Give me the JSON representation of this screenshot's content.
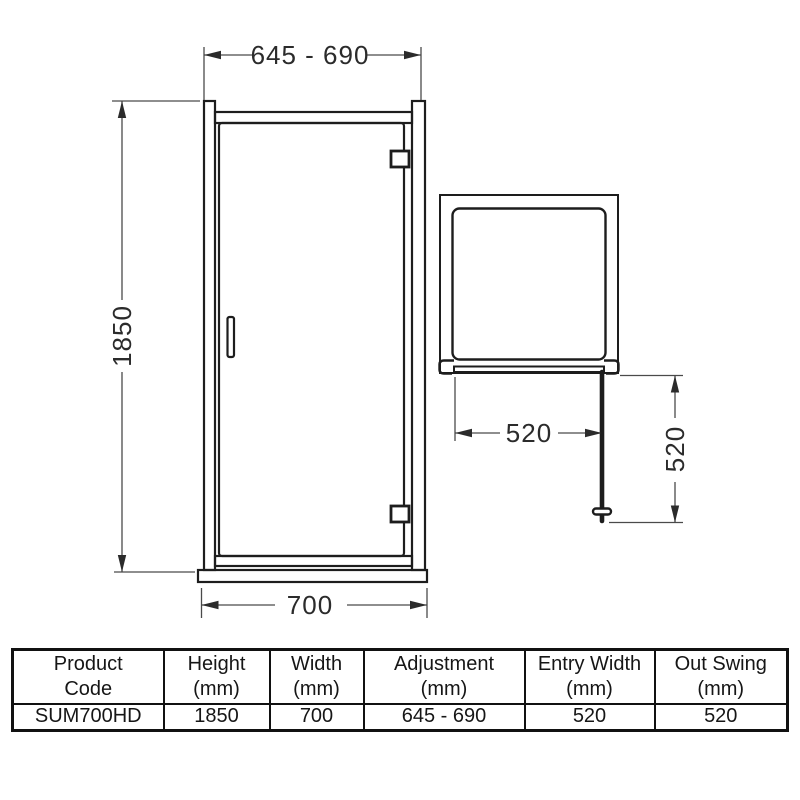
{
  "front_view": {
    "adjustment": "645 - 690",
    "height": "1850",
    "width": "700"
  },
  "plan_view": {
    "entry_width": "520",
    "out_swing": "520"
  },
  "colors": {
    "object_line": "#1d1d1d",
    "dimension_line": "#4a4a4a",
    "text": "#2b2b2b",
    "background": "#ffffff"
  },
  "spec_table": {
    "headers": [
      {
        "line1": "Product",
        "line2": "Code"
      },
      {
        "line1": "Height",
        "line2": "(mm)"
      },
      {
        "line1": "Width",
        "line2": "(mm)"
      },
      {
        "line1": "Adjustment",
        "line2": "(mm)"
      },
      {
        "line1": "Entry Width",
        "line2": "(mm)"
      },
      {
        "line1": "Out Swing",
        "line2": "(mm)"
      }
    ],
    "values": [
      "SUM700HD",
      "1850",
      "700",
      "645 - 690",
      "520",
      "520"
    ]
  }
}
